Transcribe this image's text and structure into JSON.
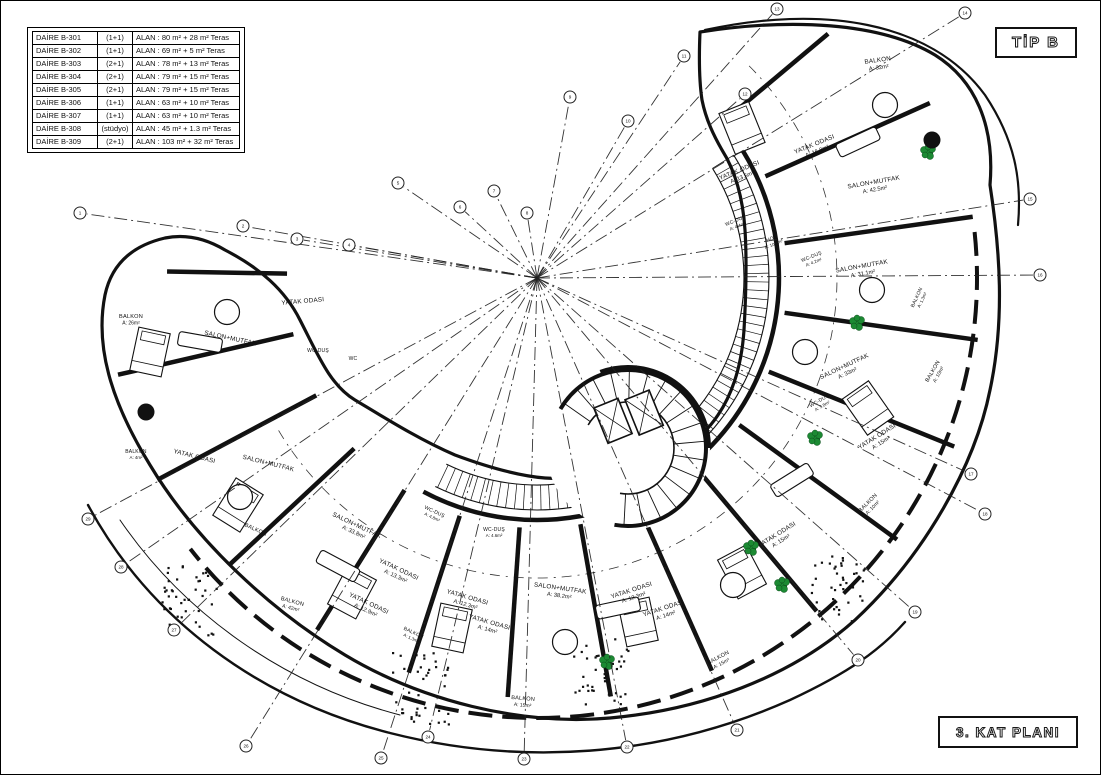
{
  "labels": {
    "type": "TİP B",
    "plan": "3. KAT PLANI"
  },
  "unit_table": {
    "rows": [
      {
        "daire": "DAİRE B-301",
        "tip": "(1+1)",
        "alan": "ALAN :  80 m² + 28 m² Teras"
      },
      {
        "daire": "DAİRE B-302",
        "tip": "(1+1)",
        "alan": "ALAN :  69 m² +  5 m² Teras"
      },
      {
        "daire": "DAİRE B-303",
        "tip": "(2+1)",
        "alan": "ALAN :  78 m² + 13 m² Teras"
      },
      {
        "daire": "DAİRE B-304",
        "tip": "(2+1)",
        "alan": "ALAN :  79 m² + 15 m² Teras"
      },
      {
        "daire": "DAİRE B-305",
        "tip": "(2+1)",
        "alan": "ALAN :  79 m² + 15 m² Teras"
      },
      {
        "daire": "DAİRE B-306",
        "tip": "(1+1)",
        "alan": "ALAN :  63 m² + 10 m² Teras"
      },
      {
        "daire": "DAİRE B-307",
        "tip": "(1+1)",
        "alan": "ALAN :  63 m² + 10 m² Teras"
      },
      {
        "daire": "DAİRE B-308",
        "tip": "(stüdyo)",
        "alan": "ALAN :  45 m² + 1.3 m² Teras"
      },
      {
        "daire": "DAİRE B-309",
        "tip": "(2+1)",
        "alan": "ALAN : 103 m² + 32 m² Teras"
      }
    ]
  },
  "plan": {
    "center": {
      "x": 537,
      "y": 278
    },
    "colors": {
      "line": "#111111",
      "tree": "#1c8a33",
      "tree_edge": "#0c4d1c"
    },
    "rooms": [
      {
        "name": "BALKON",
        "area": "A: 32m²",
        "x": 878,
        "y": 62,
        "rot": -8
      },
      {
        "name": "YATAK ODASI",
        "area": "A: 13.5m²",
        "x": 740,
        "y": 172,
        "rot": -22
      },
      {
        "name": "YATAK ODASI",
        "area": "A: 16.8m²",
        "x": 815,
        "y": 146,
        "rot": -22
      },
      {
        "name": "SALON+MUTFAK",
        "area": "A: 42.5m²",
        "x": 874,
        "y": 184,
        "rot": -10
      },
      {
        "name": "WC-DUŞ",
        "area": "A: 4.4m²",
        "x": 736,
        "y": 222,
        "rot": -22,
        "s": 5
      },
      {
        "name": "HOL",
        "area": "A: 10.8m²",
        "x": 772,
        "y": 240,
        "rot": -22,
        "s": 5
      },
      {
        "name": "WC-DUŞ",
        "area": "A: 4.2m²",
        "x": 812,
        "y": 258,
        "rot": -22,
        "s": 5
      },
      {
        "name": "SALON+MUTFAK",
        "area": "A: 31.1m²",
        "x": 862,
        "y": 268,
        "rot": -10
      },
      {
        "name": "BALKON",
        "area": "A: 1.3m²",
        "x": 918,
        "y": 298,
        "rot": -65,
        "s": 5
      },
      {
        "name": "SALON+MUTFAK",
        "area": "A: 33m²",
        "x": 845,
        "y": 368,
        "rot": -25
      },
      {
        "name": "BALKON",
        "area": "A: 10m²",
        "x": 934,
        "y": 372,
        "rot": -60,
        "s": 5.6
      },
      {
        "name": "WC-DUŞ",
        "area": "A: 3.8m²",
        "x": 820,
        "y": 402,
        "rot": -30,
        "s": 5
      },
      {
        "name": "YATAK ODASI",
        "area": "A: 15m²",
        "x": 878,
        "y": 438,
        "rot": -32
      },
      {
        "name": "BALKON",
        "area": "A: 10m²",
        "x": 869,
        "y": 504,
        "rot": -45,
        "s": 5.6
      },
      {
        "name": "YATAK ODASI",
        "area": "A: 15m²",
        "x": 778,
        "y": 536,
        "rot": -32
      },
      {
        "name": "SALON+MUTFAK",
        "area": "A: 38.2m²",
        "x": 560,
        "y": 590,
        "rot": 8
      },
      {
        "name": "YATAK ODASI",
        "area": "A: 12.3m²",
        "x": 632,
        "y": 592,
        "rot": -18
      },
      {
        "name": "YATAK ODASI",
        "area": "A: 14m²",
        "x": 664,
        "y": 610,
        "rot": -18
      },
      {
        "name": "BALKON",
        "area": "A: 15m²",
        "x": 523,
        "y": 700,
        "rot": 5,
        "s": 5.6
      },
      {
        "name": "BALKON",
        "area": "A: 15m²",
        "x": 719,
        "y": 659,
        "rot": -28,
        "s": 5.6
      },
      {
        "name": "YATAK ODASI",
        "area": "A: 12.3m²",
        "x": 467,
        "y": 599,
        "rot": 16
      },
      {
        "name": "YATAK ODASI",
        "area": "A: 14m²",
        "x": 489,
        "y": 624,
        "rot": 16
      },
      {
        "name": "WC-DUŞ",
        "area": "A: 4.6m²",
        "x": 494,
        "y": 531,
        "rot": 0,
        "s": 5
      },
      {
        "name": "WC-DUŞ",
        "area": "A: 4.8m²",
        "x": 434,
        "y": 513,
        "rot": 25,
        "s": 5
      },
      {
        "name": "SALON+MUTFAK",
        "area": "A: 33.8m²",
        "x": 356,
        "y": 527,
        "rot": 25
      },
      {
        "name": "YATAK ODASI",
        "area": "A: 13.3m²",
        "x": 398,
        "y": 571,
        "rot": 25
      },
      {
        "name": "YATAK ODASI",
        "area": "A: 12.9m²",
        "x": 368,
        "y": 605,
        "rot": 25
      },
      {
        "name": "BALKON",
        "area": "A: 1.3m²",
        "x": 413,
        "y": 634,
        "rot": 25,
        "s": 5
      },
      {
        "name": "BALKON",
        "area": "A: 42m²",
        "x": 292,
        "y": 603,
        "rot": 15,
        "s": 5.6
      },
      {
        "name": "BALKON",
        "area": "",
        "x": 255,
        "y": 531,
        "rot": 25,
        "s": 5.6
      },
      {
        "name": "BALKON",
        "area": "A: 26m²",
        "x": 131,
        "y": 318,
        "rot": 0,
        "s": 5.6
      },
      {
        "name": "SALON+MUTFAK",
        "area": "",
        "x": 230,
        "y": 340,
        "rot": 12
      },
      {
        "name": "YATAK ODASI",
        "area": "",
        "x": 303,
        "y": 303,
        "rot": -5
      },
      {
        "name": "WC-DUŞ",
        "area": "",
        "x": 318,
        "y": 352,
        "rot": 0,
        "s": 5
      },
      {
        "name": "WC",
        "area": "",
        "x": 353,
        "y": 360,
        "rot": 0,
        "s": 5
      },
      {
        "name": "BALKON",
        "area": "A: 4m²",
        "x": 136,
        "y": 453,
        "rot": 0,
        "s": 5
      },
      {
        "name": "YATAK ODASI",
        "area": "",
        "x": 194,
        "y": 458,
        "rot": 14
      },
      {
        "name": "SALON+MUTFAK",
        "area": "",
        "x": 268,
        "y": 465,
        "rot": 14
      }
    ],
    "axes": [
      {
        "label": "1",
        "x": 80,
        "y": 213
      },
      {
        "label": "2",
        "x": 243,
        "y": 226
      },
      {
        "label": "3",
        "x": 297,
        "y": 239
      },
      {
        "label": "4",
        "x": 349,
        "y": 245
      },
      {
        "label": "5",
        "x": 398,
        "y": 183
      },
      {
        "label": "6",
        "x": 460,
        "y": 207
      },
      {
        "label": "7",
        "x": 494,
        "y": 191
      },
      {
        "label": "8",
        "x": 527,
        "y": 213
      },
      {
        "label": "9",
        "x": 570,
        "y": 97
      },
      {
        "label": "10",
        "x": 628,
        "y": 121
      },
      {
        "label": "11",
        "x": 684,
        "y": 56
      },
      {
        "label": "12",
        "x": 745,
        "y": 94
      },
      {
        "label": "13",
        "x": 777,
        "y": 9
      },
      {
        "label": "14",
        "x": 965,
        "y": 13
      },
      {
        "label": "15",
        "x": 1030,
        "y": 199
      },
      {
        "label": "16",
        "x": 1040,
        "y": 275
      },
      {
        "label": "17",
        "x": 971,
        "y": 474
      },
      {
        "label": "18",
        "x": 985,
        "y": 514
      },
      {
        "label": "19",
        "x": 915,
        "y": 612
      },
      {
        "label": "20",
        "x": 858,
        "y": 660
      },
      {
        "label": "21",
        "x": 737,
        "y": 730
      },
      {
        "label": "22",
        "x": 627,
        "y": 747
      },
      {
        "label": "23",
        "x": 524,
        "y": 759
      },
      {
        "label": "24",
        "x": 428,
        "y": 737
      },
      {
        "label": "25",
        "x": 381,
        "y": 758
      },
      {
        "label": "26",
        "x": 246,
        "y": 746
      },
      {
        "label": "27",
        "x": 174,
        "y": 630
      },
      {
        "label": "28",
        "x": 121,
        "y": 567
      },
      {
        "label": "29",
        "x": 88,
        "y": 519
      }
    ],
    "trees": [
      {
        "x": 928,
        "y": 152
      },
      {
        "x": 857,
        "y": 323
      },
      {
        "x": 815,
        "y": 438
      },
      {
        "x": 751,
        "y": 548
      },
      {
        "x": 782,
        "y": 585
      },
      {
        "x": 607,
        "y": 662
      }
    ],
    "columns": [
      {
        "x": 932,
        "y": 140
      },
      {
        "x": 146,
        "y": 412
      }
    ]
  }
}
